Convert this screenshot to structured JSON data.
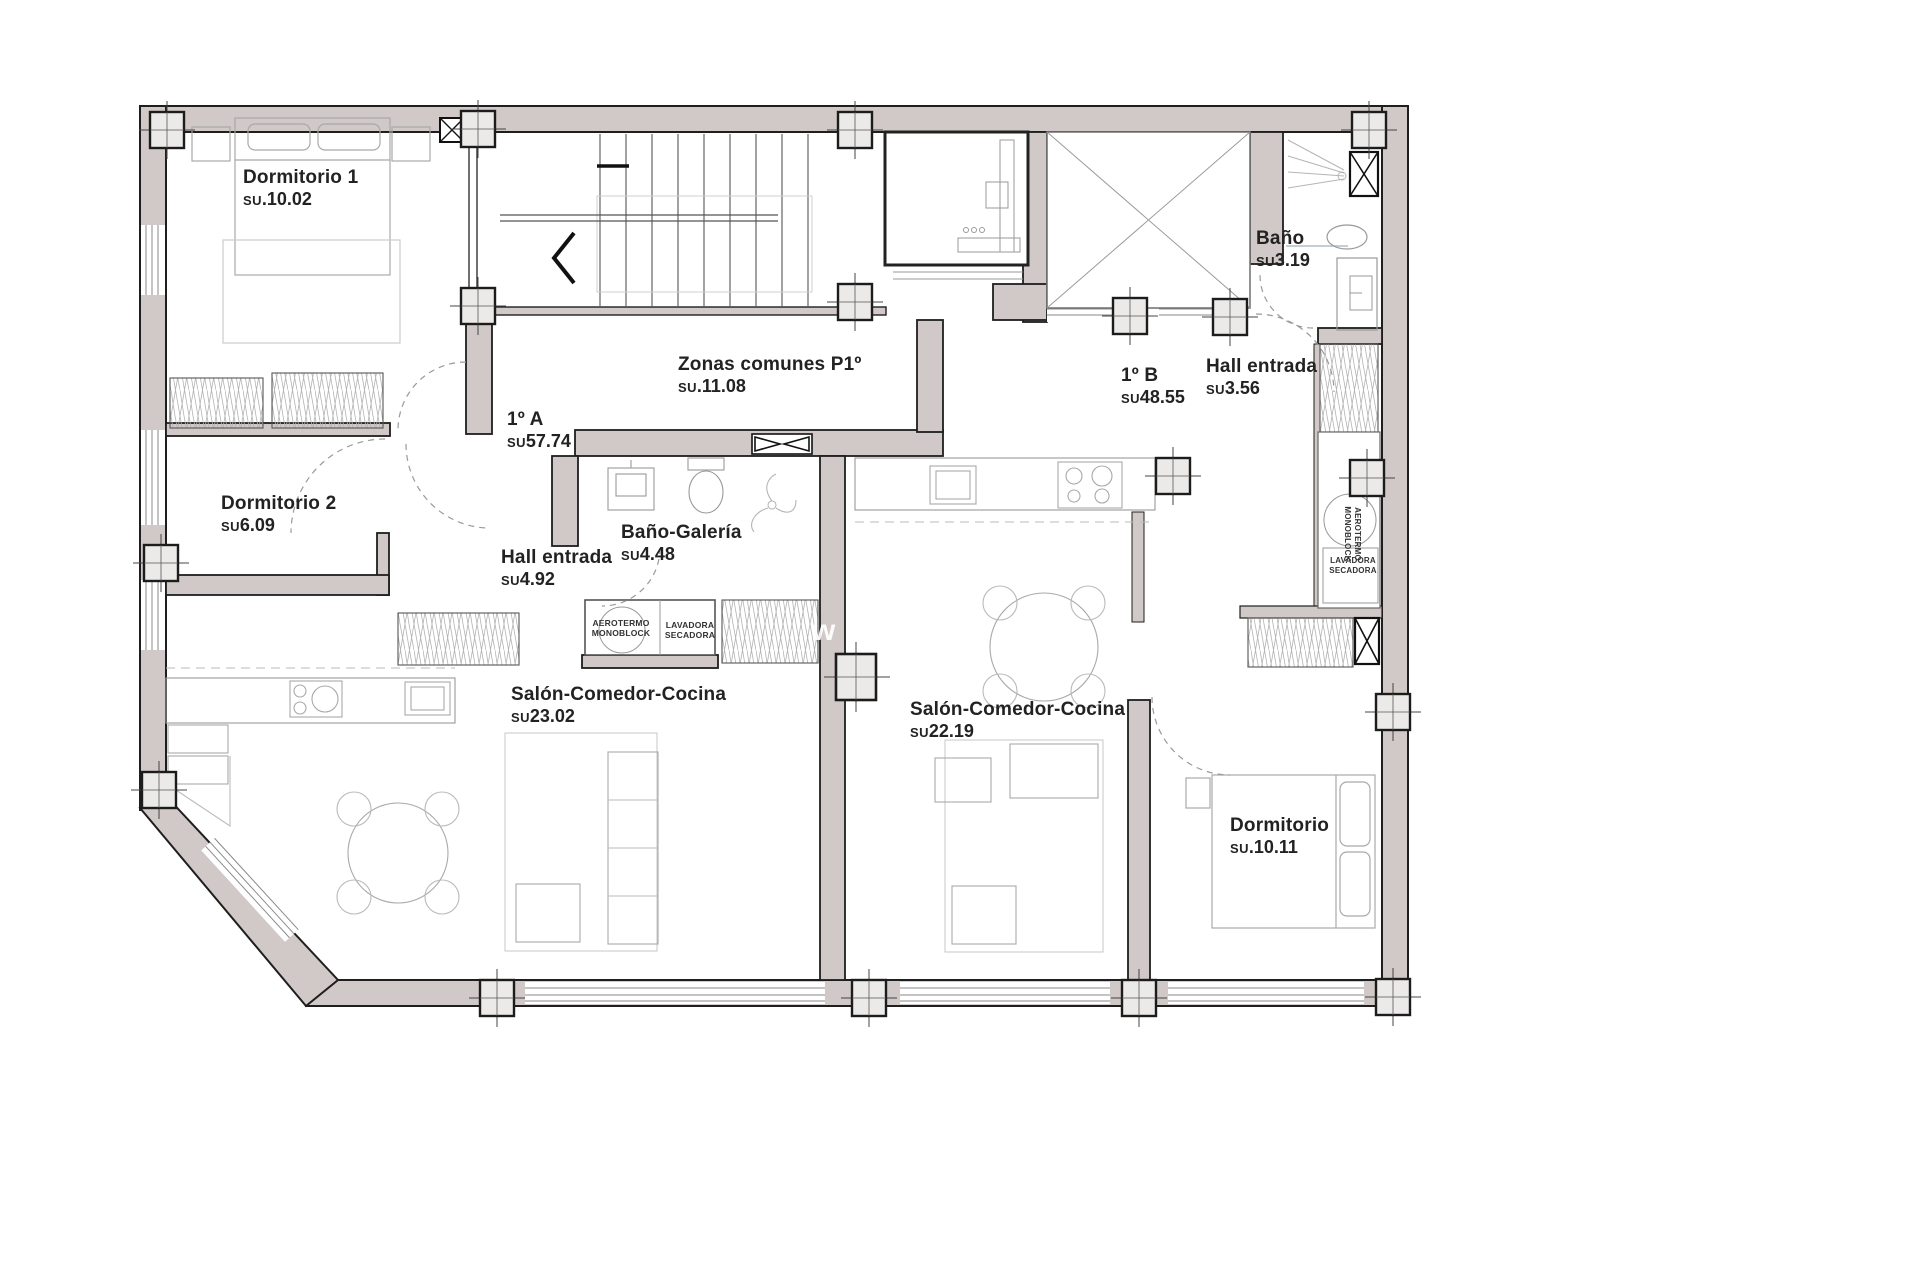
{
  "rooms": [
    {
      "id": "dormitorio-1",
      "name": "Dormitorio 1",
      "su": "SU",
      "area": ".10.02"
    },
    {
      "id": "zonas-comunes",
      "name": "Zonas comunes P1º",
      "su": "SU",
      "area": ".11.08"
    },
    {
      "id": "vivienda-1a",
      "name": "1º A",
      "su": "SU",
      "area": "57.74"
    },
    {
      "id": "vivienda-1b",
      "name": "1º B",
      "su": "SU",
      "area": "48.55"
    },
    {
      "id": "bano-1b",
      "name": "Baño",
      "su": "SU",
      "area": "3.19"
    },
    {
      "id": "hall-entrada-1b",
      "name": "Hall entrada",
      "su": "SU",
      "area": "3.56"
    },
    {
      "id": "dormitorio-2",
      "name": "Dormitorio 2",
      "su": "SU",
      "area": "6.09"
    },
    {
      "id": "hall-entrada-1a",
      "name": "Hall entrada",
      "su": "SU",
      "area": "4.92"
    },
    {
      "id": "bano-galeria",
      "name": "Baño-Galería",
      "su": "SU",
      "area": "4.48"
    },
    {
      "id": "salon-1a",
      "name": "Salón-Comedor-Cocina",
      "su": "SU",
      "area": "23.02"
    },
    {
      "id": "salon-1b",
      "name": "Salón-Comedor-Cocina",
      "su": "SU",
      "area": "22.19"
    },
    {
      "id": "dormitorio-1b",
      "name": "Dormitorio",
      "su": "SU",
      "area": ".10.11"
    }
  ],
  "utilities": {
    "aerotermo": "AEROTERMO MONOBLOCK",
    "lavadora": "LAVADORA SECADORA"
  },
  "watermark": "w",
  "colors": {
    "wall_fill": "#d0c9c7",
    "wall_line": "#1e1e1e",
    "furniture_line": "#a9a9a9"
  }
}
